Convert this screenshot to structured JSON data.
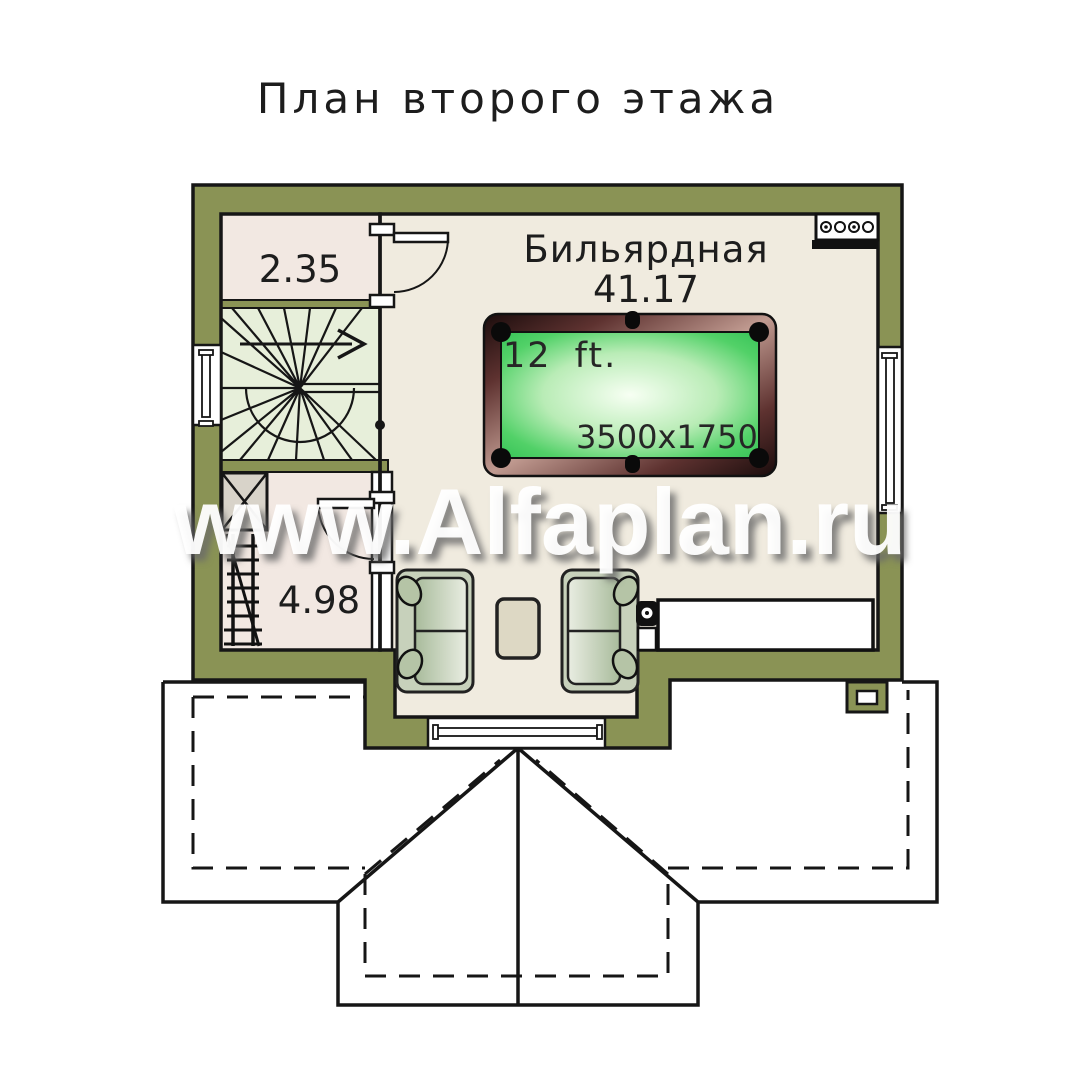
{
  "title": "План второго этажа",
  "watermark": "www.Alfaplan.ru",
  "rooms": {
    "billiard": {
      "name": "Бильярдная",
      "area": "41.17"
    },
    "storage_top": {
      "area": "2.35"
    },
    "storage_bottom": {
      "area": "4.98"
    }
  },
  "billiard_table": {
    "size_label": "12 ft.",
    "dimensions_label": "3500x1750"
  },
  "colors": {
    "wall_olive": "#8a9355",
    "floor_main": "#f0ebdf",
    "floor_storage": "#f2e8e2",
    "floor_stairs": "#e7efda",
    "table_felt": "#3fca5c",
    "table_frame": "#5e3230",
    "outline": "#161616"
  }
}
